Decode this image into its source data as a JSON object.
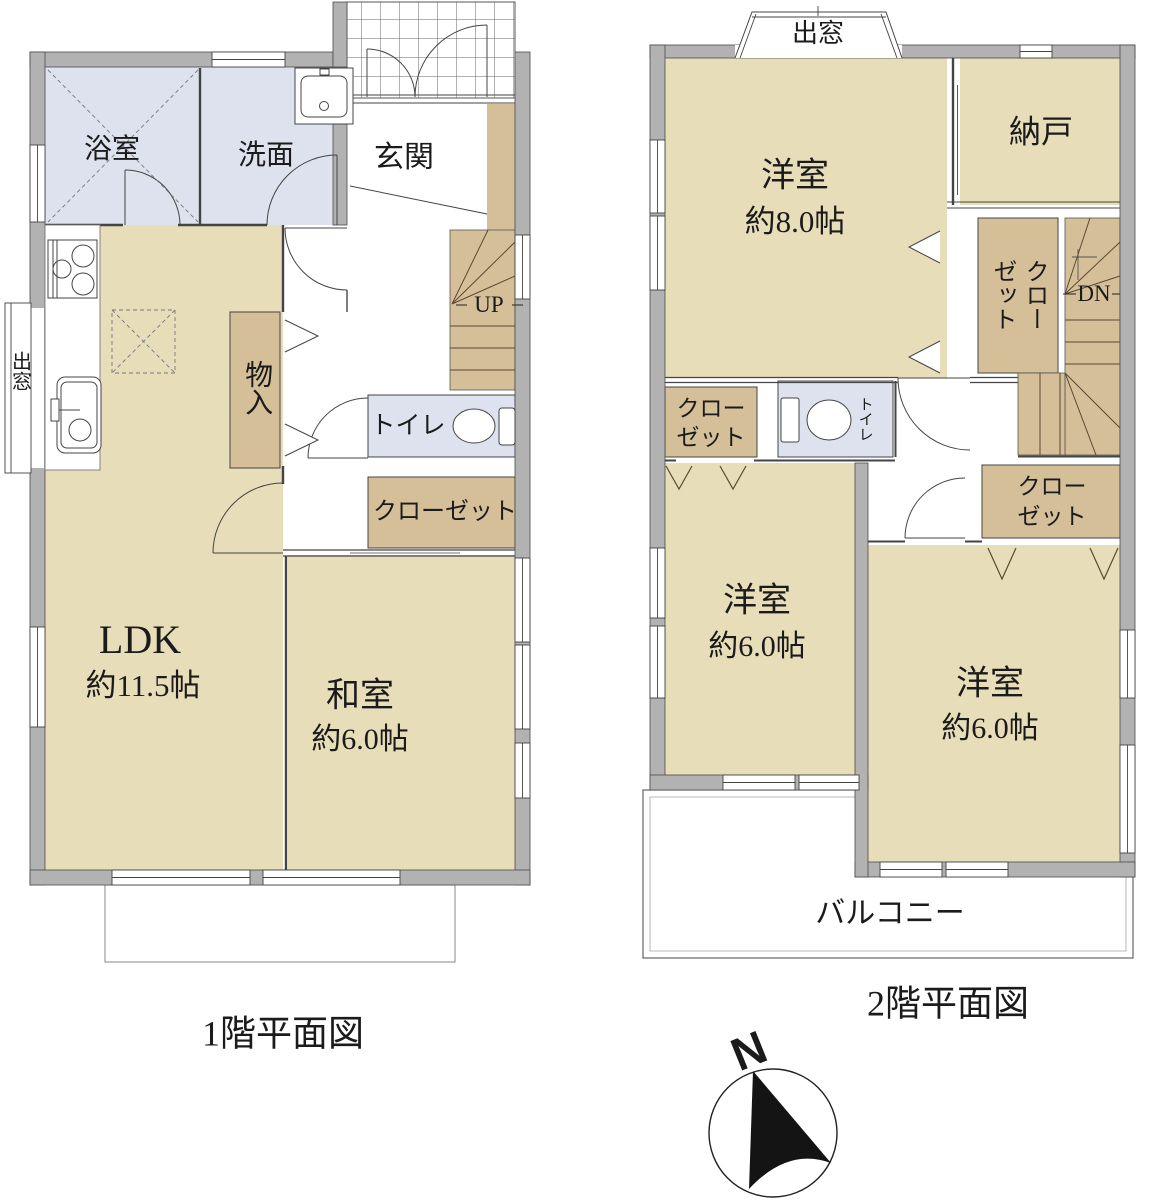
{
  "colors": {
    "wall": "#b2b2b2",
    "room_floor": "#e8ddb9",
    "closet_floor": "#d5bf98",
    "wet_floor": "#dde2ee",
    "outline": "#444444"
  },
  "floor1": {
    "title": "1階平面図",
    "bath": "浴室",
    "washroom": "洗面",
    "entrance": "玄関",
    "ldk_name": "LDK",
    "ldk_size": "約11.5帖",
    "japanese_room_name": "和室",
    "japanese_room_size": "約6.0帖",
    "toilet": "トイレ",
    "closet": "クローゼット",
    "storage": "物入",
    "bay_window": "出窓",
    "stairs": "UP"
  },
  "floor2": {
    "title": "2階平面図",
    "bay_window": "出窓",
    "bedroom8_name": "洋室",
    "bedroom8_size": "約8.0帖",
    "storeroom": "納戸",
    "closet_stairside": "クローゼット",
    "closet_line1": "クロー",
    "closet_line2": "ゼット",
    "stairs": "DN",
    "toilet": "トイレ",
    "bedroom6a_name": "洋室",
    "bedroom6a_size": "約6.0帖",
    "bedroom6b_name": "洋室",
    "bedroom6b_size": "約6.0帖",
    "balcony": "バルコニー"
  },
  "compass": {
    "north": "N"
  }
}
